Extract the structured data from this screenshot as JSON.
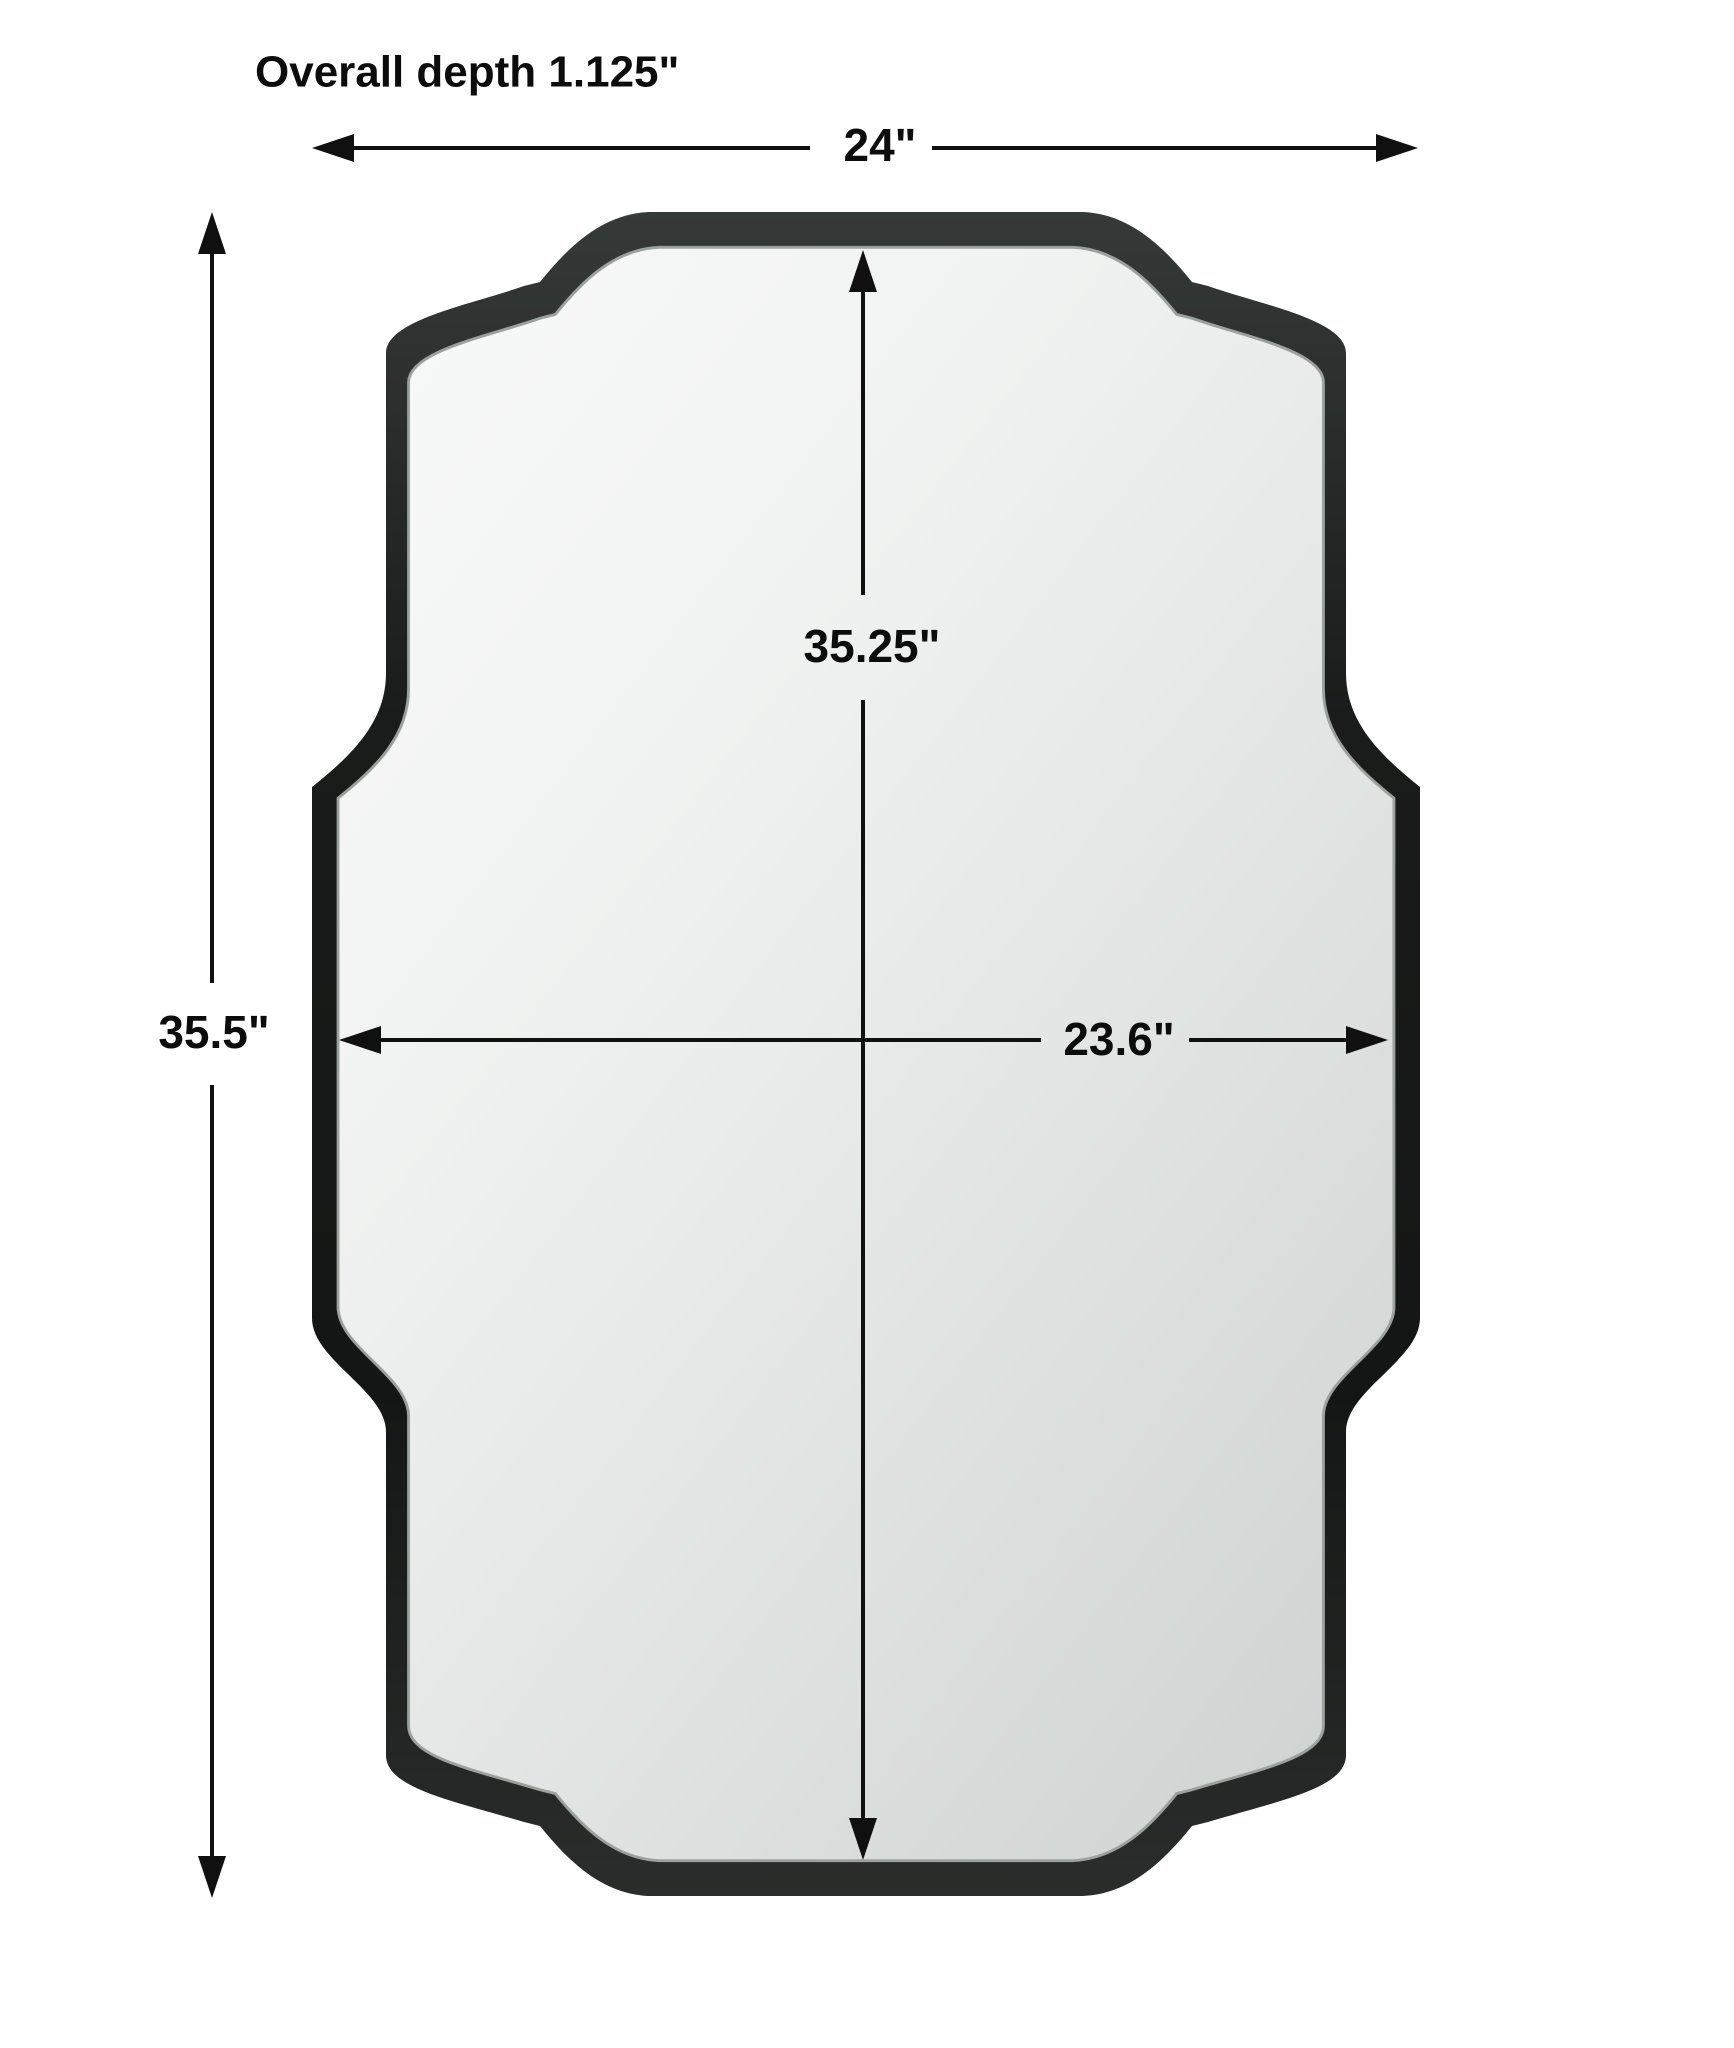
{
  "title": {
    "text": "Overall depth 1.125\""
  },
  "dimension_labels": {
    "overall_width": "24\"",
    "overall_height": "35.5\"",
    "inner_height": "35.25\"",
    "inner_width": "23.6\""
  },
  "colors": {
    "background": "#ffffff",
    "dimension_line": "#101010",
    "label_text": "#0c0c0c",
    "frame_dark": "#141615",
    "frame_light": "#353937",
    "frame_lip": "#9ba19d",
    "glass_light": "#f9fafa",
    "glass_dark": "#d0d4d2"
  }
}
